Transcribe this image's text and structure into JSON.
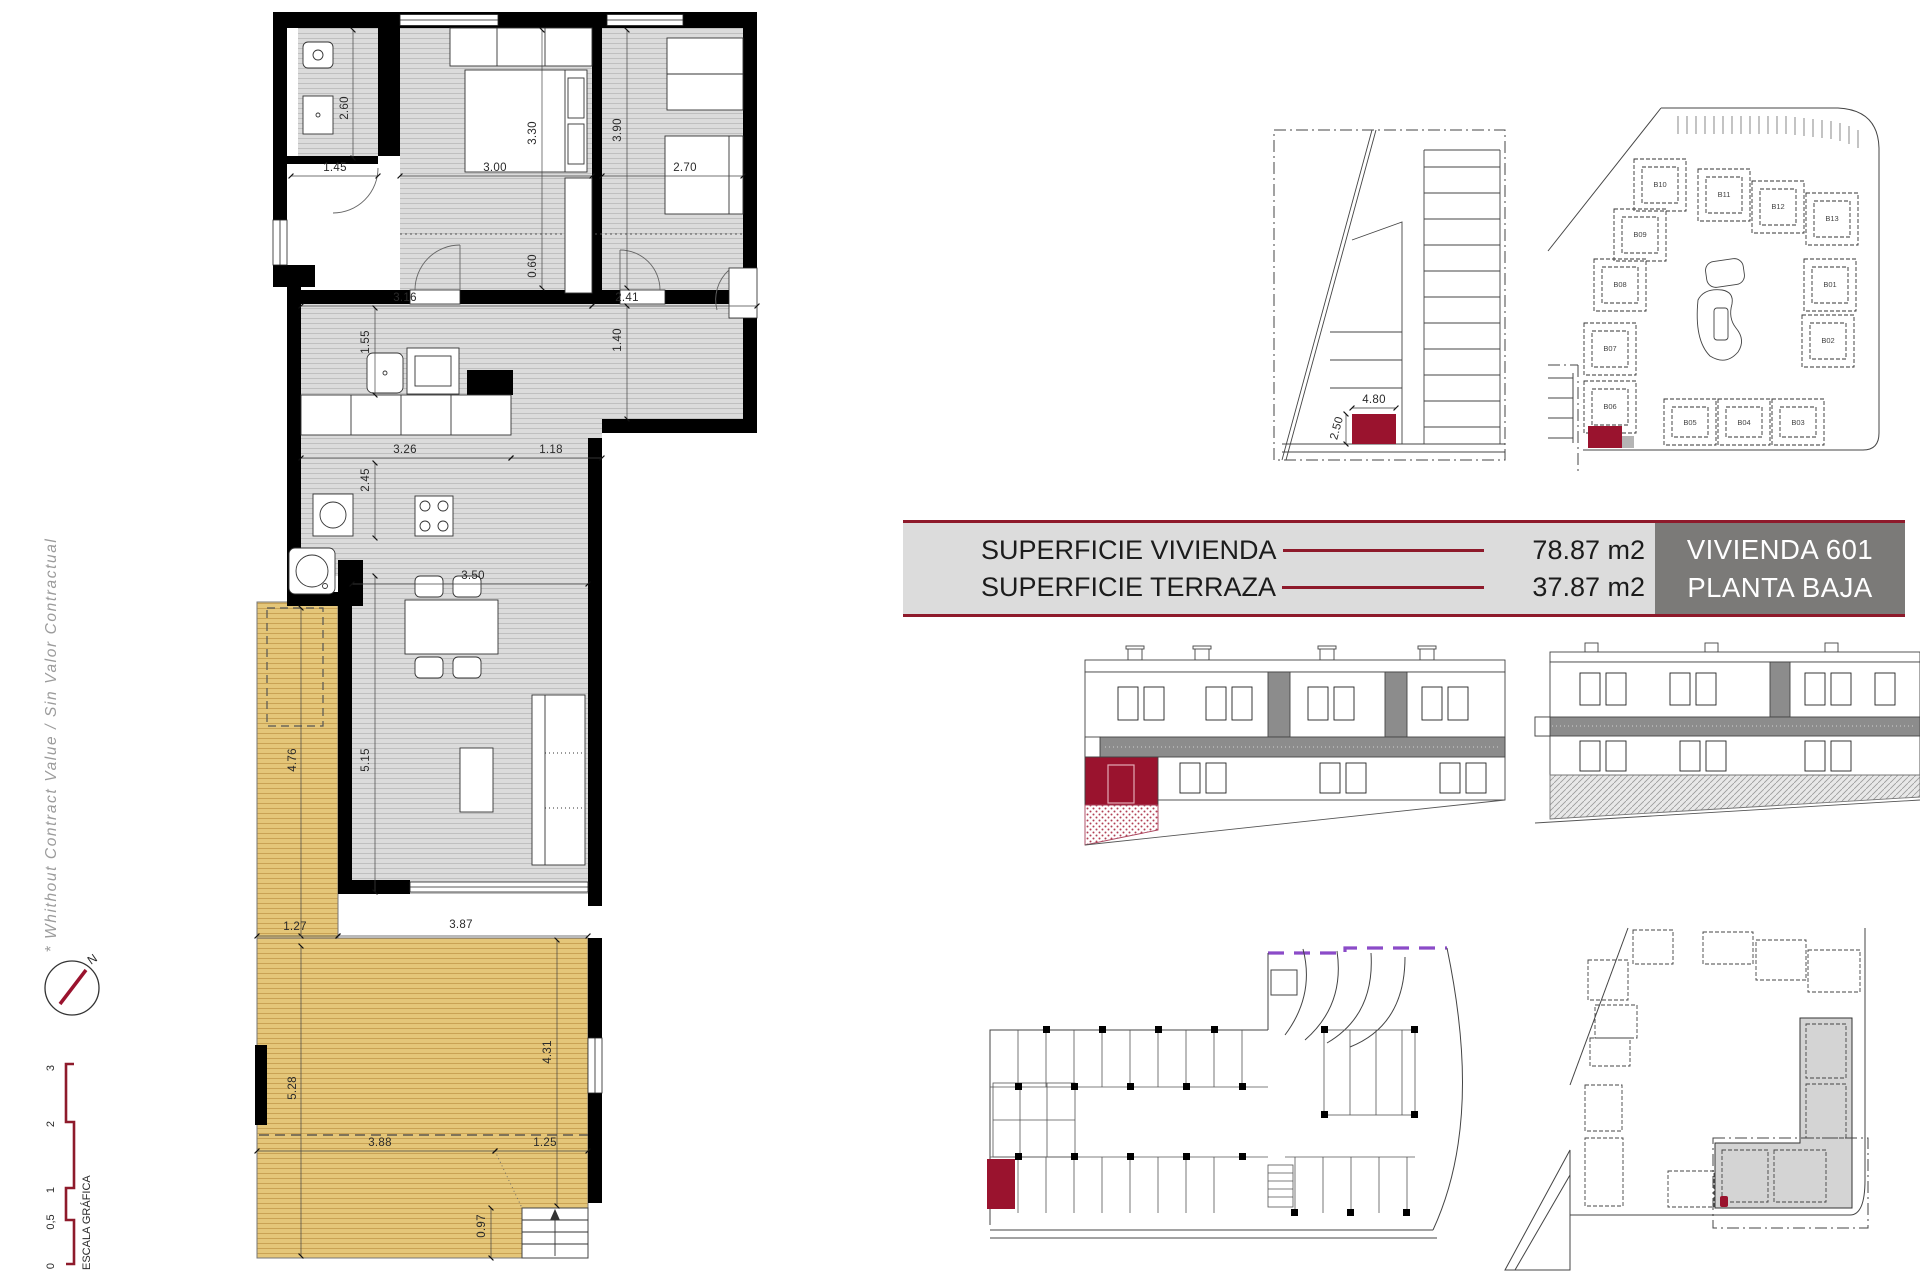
{
  "colors": {
    "accent_red": "#9A132E",
    "line_red": "#8E1A2B",
    "terrace_yellow": "#E4C679",
    "floor_gray": "#DBDBDB",
    "unit_box_gray": "#7B7A78",
    "table_bg": "#DCDCDC",
    "ramp_purple": "#8B4BC8"
  },
  "side_note": "* Whithout Contract Value / Sin Valor Contractual",
  "compass": {
    "north": "N"
  },
  "scale_bar": {
    "title": "ESCALA GRÁFICA",
    "marks": [
      "3",
      "2",
      "1",
      "0,5",
      "0"
    ]
  },
  "info_table": {
    "rows": [
      {
        "label": "SUPERFICIE VIVIENDA",
        "value": "78.87 m2"
      },
      {
        "label": "SUPERFICIE TERRAZA",
        "value": "37.87 m2"
      }
    ],
    "unit_name": "VIVIENDA 601",
    "unit_floor": "PLANTA BAJA"
  },
  "floor_plan": {
    "dims": {
      "bath_height": "2.60",
      "bath_width": "1.45",
      "bed1_width": "3.00",
      "bed1_height": "3.30",
      "bed2_height": "3.90",
      "bed2_width": "2.70",
      "closet": "0.60",
      "hall_left": "3.16",
      "hall_right": "2.41",
      "entry": "1.40",
      "bath2": "1.55",
      "kitchen_w": "3.26",
      "pass": "1.18",
      "kitchen_h": "2.45",
      "living_w": "3.50",
      "living_h": "5.15",
      "terrace1_h": "4.76",
      "terrace2_a": "1.27",
      "terrace2_w": "3.87",
      "terrace3_h": "5.28",
      "terrace3_b": "4.31",
      "terrace3_w": "3.88",
      "terrace3_c": "1.25",
      "stairs_w": "0.97"
    }
  },
  "parking_detail": {
    "dims": {
      "length": "4.80",
      "width": "2.50"
    }
  },
  "site_plan": {
    "units": [
      "B01",
      "B02",
      "B03",
      "B04",
      "B05",
      "B06",
      "B07",
      "B08",
      "B09",
      "B10",
      "B11",
      "B12",
      "B13"
    ]
  }
}
